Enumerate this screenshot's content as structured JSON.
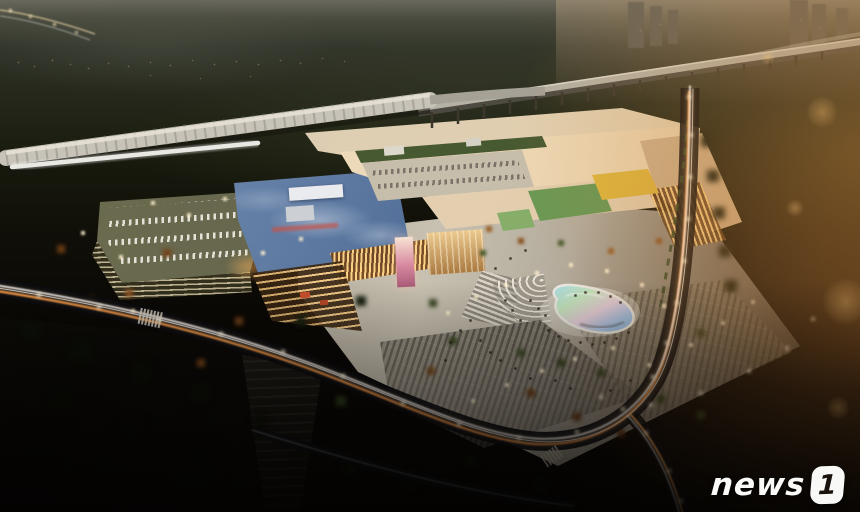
{
  "scene": {
    "alt": "Aerial dusk rendering of a large shopping mall complex beside a covered railway station and elevated viaduct, with light-trail roads, a free-form plaza pool, parking garage and surface lots"
  },
  "watermark": {
    "text": "news",
    "number": "1"
  },
  "palette": {
    "sky_dusk": "#3c3e33",
    "flare_amber": "#e8a050",
    "mall_roof_cream": "#ece0c8",
    "department_store_blue": "#54719b",
    "green_roof": "#6f9e58",
    "yellow_canopy": "#e2bd42",
    "pool_cyan": "#a8dce8",
    "pool_pink": "#e8d2e0",
    "light_trail_amber": "#ff9e4a",
    "road_dark": "#0b0c10",
    "plaza_concrete": "#c9c2b2",
    "watermark_white": "#f8f8f6"
  }
}
